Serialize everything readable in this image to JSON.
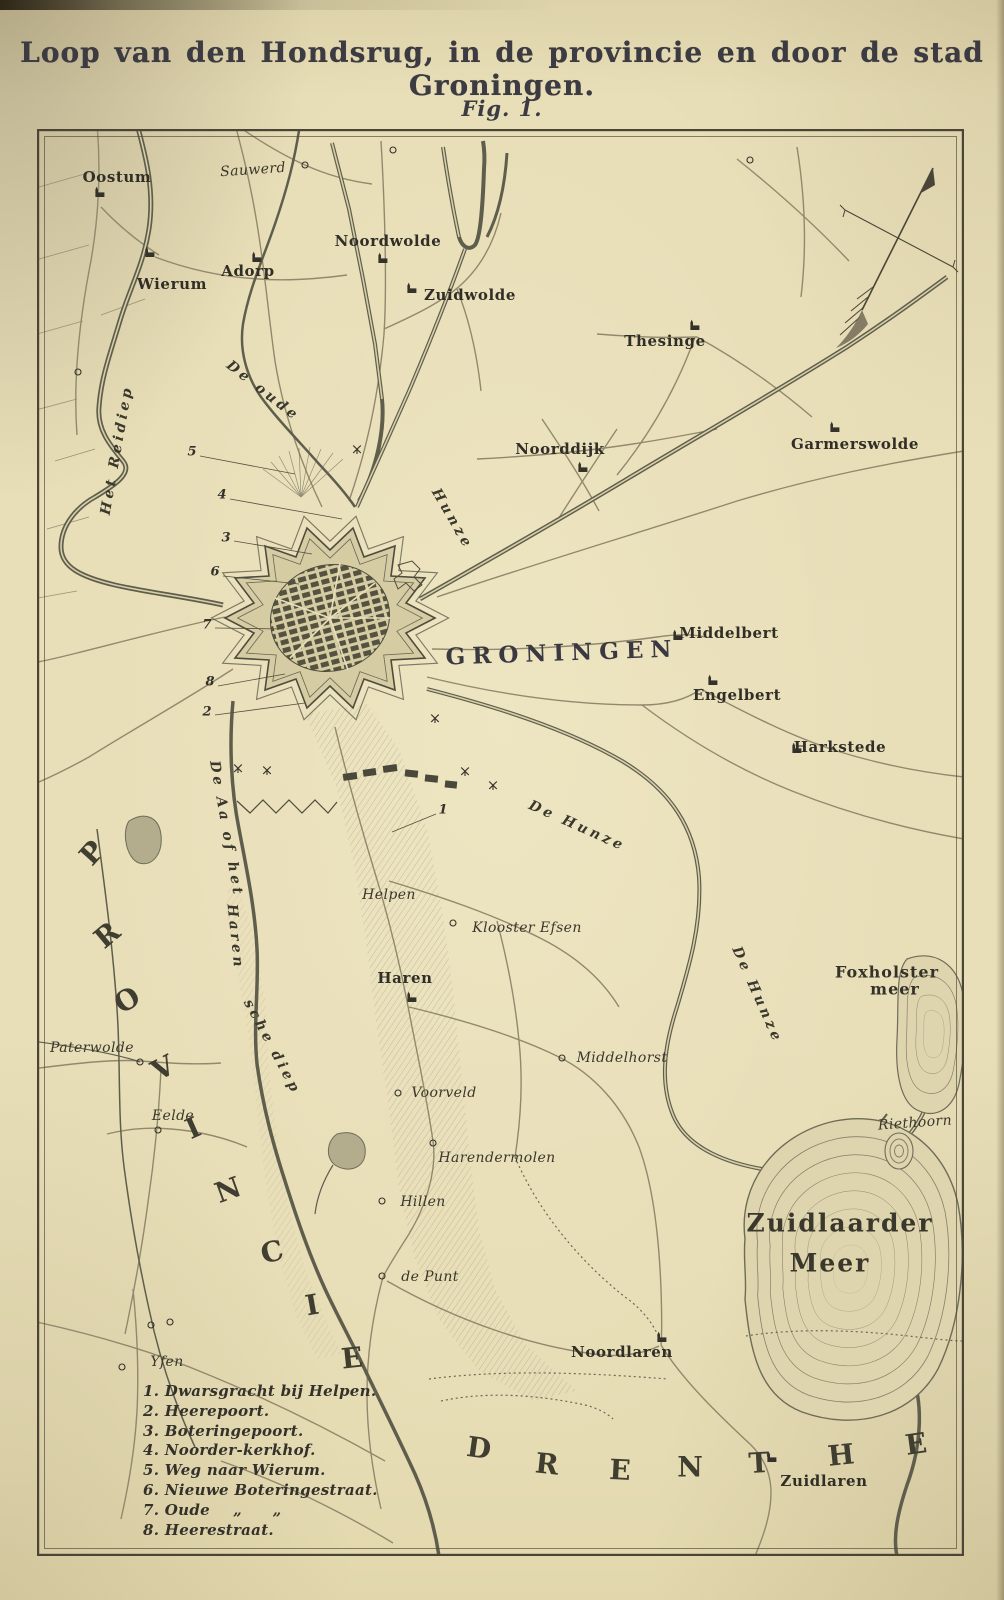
{
  "page": {
    "title": "Loop van den Hondsrug, in de provincie en door de stad Groningen.",
    "figure_caption": "Fig. 1."
  },
  "colors": {
    "paper": "#e7ddb6",
    "ink": "#3b382d",
    "water": "#5f5e4d",
    "road": "#92896d",
    "hatch": "#8f876c",
    "frame": "#4a4537"
  },
  "map": {
    "labels": [
      {
        "t": "Oostum",
        "x": 80,
        "y": 48,
        "c": "village"
      },
      {
        "t": "Sauwerd",
        "x": 216,
        "y": 41,
        "r": -4,
        "c": "hamlet"
      },
      {
        "t": "Noordwolde",
        "x": 351,
        "y": 112,
        "c": "village"
      },
      {
        "t": "Zuidwolde",
        "x": 433,
        "y": 166,
        "c": "village"
      },
      {
        "t": "Wierum",
        "x": 135,
        "y": 155,
        "c": "village"
      },
      {
        "t": "Adorp",
        "x": 211,
        "y": 142,
        "c": "village"
      },
      {
        "t": "Thesinge",
        "x": 628,
        "y": 212,
        "c": "village"
      },
      {
        "t": "Noorddijk",
        "x": 523,
        "y": 320,
        "c": "village"
      },
      {
        "t": "Garmerswolde",
        "x": 818,
        "y": 315,
        "c": "village"
      },
      {
        "t": "GRONINGEN",
        "x": 525,
        "y": 524,
        "r": -2,
        "c": "city"
      },
      {
        "t": "Middelbert",
        "x": 692,
        "y": 504,
        "c": "village"
      },
      {
        "t": "Engelbert",
        "x": 700,
        "y": 566,
        "c": "village"
      },
      {
        "t": "Harkstede",
        "x": 803,
        "y": 618,
        "c": "village"
      },
      {
        "t": "Helpen",
        "x": 352,
        "y": 766,
        "c": "hamlet"
      },
      {
        "t": "Klooster Efsen",
        "x": 490,
        "y": 799,
        "c": "hamlet"
      },
      {
        "t": "Haren",
        "x": 368,
        "y": 849,
        "c": "village"
      },
      {
        "t": "Middelhorst",
        "x": 585,
        "y": 929,
        "c": "hamlet"
      },
      {
        "t": "Voorveld",
        "x": 407,
        "y": 964,
        "c": "hamlet"
      },
      {
        "t": "Harendermolen",
        "x": 460,
        "y": 1029,
        "c": "hamlet"
      },
      {
        "t": "Hillen",
        "x": 386,
        "y": 1073,
        "c": "hamlet"
      },
      {
        "t": "de Punt",
        "x": 393,
        "y": 1148,
        "c": "hamlet"
      },
      {
        "t": "Paterwolde",
        "x": 55,
        "y": 919,
        "c": "hamlet"
      },
      {
        "t": "Eelde",
        "x": 136,
        "y": 987,
        "c": "hamlet"
      },
      {
        "t": "Yfen",
        "x": 130,
        "y": 1233,
        "c": "hamlet"
      },
      {
        "t": "Noordlaren",
        "x": 585,
        "y": 1223,
        "c": "village"
      },
      {
        "t": "Zuidlaren",
        "x": 787,
        "y": 1352,
        "c": "village"
      },
      {
        "t": "Riethoorn",
        "x": 878,
        "y": 994,
        "r": -4,
        "c": "hamlet"
      },
      {
        "t": "Foxholster",
        "x": 850,
        "y": 843,
        "c": "water-name"
      },
      {
        "t": "meer",
        "x": 858,
        "y": 860,
        "c": "water-name"
      },
      {
        "t": "Zuidlaarder",
        "x": 803,
        "y": 1094,
        "c": "lake-name"
      },
      {
        "t": "Meer",
        "x": 793,
        "y": 1134,
        "c": "lake-name"
      },
      {
        "t": "Het Reidiep",
        "x": 80,
        "y": 321,
        "r": -80,
        "c": "river"
      },
      {
        "t": "De oude",
        "x": 226,
        "y": 262,
        "r": 38,
        "c": "river"
      },
      {
        "t": "Hunze",
        "x": 415,
        "y": 390,
        "r": 60,
        "c": "river"
      },
      {
        "t": "De Hunze",
        "x": 540,
        "y": 697,
        "r": 24,
        "c": "river"
      },
      {
        "t": "De Hunze",
        "x": 720,
        "y": 866,
        "r": 66,
        "c": "river"
      },
      {
        "t": "De Aa of het",
        "x": 189,
        "y": 700,
        "r": 80,
        "c": "river"
      },
      {
        "t": "Haren",
        "x": 198,
        "y": 808,
        "r": 84,
        "c": "river"
      },
      {
        "t": "sche diep",
        "x": 235,
        "y": 918,
        "r": 62,
        "c": "river"
      }
    ],
    "regions": [
      {
        "word": "PROVINCIE",
        "letters": [
          {
            "ch": "P",
            "x": 55,
            "y": 724,
            "r": -48
          },
          {
            "ch": "R",
            "x": 70,
            "y": 806,
            "r": -40
          },
          {
            "ch": "O",
            "x": 90,
            "y": 871,
            "r": -32
          },
          {
            "ch": "V",
            "x": 126,
            "y": 939,
            "r": -28
          },
          {
            "ch": "I",
            "x": 156,
            "y": 999,
            "r": -24
          },
          {
            "ch": "N",
            "x": 191,
            "y": 1061,
            "r": -20
          },
          {
            "ch": "C",
            "x": 235,
            "y": 1123,
            "r": -14
          },
          {
            "ch": "I",
            "x": 275,
            "y": 1176,
            "r": -10
          },
          {
            "ch": "E",
            "x": 315,
            "y": 1229,
            "r": -6
          }
        ]
      },
      {
        "word": "DRENTHE",
        "letters": [
          {
            "ch": "D",
            "x": 442,
            "y": 1319,
            "r": 8
          },
          {
            "ch": "R",
            "x": 510,
            "y": 1335,
            "r": 6
          },
          {
            "ch": "E",
            "x": 583,
            "y": 1341,
            "r": 3
          },
          {
            "ch": "N",
            "x": 653,
            "y": 1338,
            "r": 0
          },
          {
            "ch": "T",
            "x": 722,
            "y": 1334,
            "r": -3
          },
          {
            "ch": "H",
            "x": 804,
            "y": 1326,
            "r": -6
          },
          {
            "ch": "E",
            "x": 879,
            "y": 1315,
            "r": -8
          }
        ]
      }
    ],
    "numbers": [
      {
        "t": "5",
        "x": 155,
        "y": 323
      },
      {
        "t": "4",
        "x": 185,
        "y": 366
      },
      {
        "t": "3",
        "x": 189,
        "y": 409
      },
      {
        "t": "6",
        "x": 178,
        "y": 443
      },
      {
        "t": "7",
        "x": 170,
        "y": 496
      },
      {
        "t": "8",
        "x": 173,
        "y": 553
      },
      {
        "t": "2",
        "x": 170,
        "y": 583
      },
      {
        "t": "1",
        "x": 406,
        "y": 681
      }
    ],
    "legend": {
      "items": [
        "1. Dwarsgracht bij Helpen.",
        "2. Heerepoort.",
        "3. Boteringepoort.",
        "4. Noorder-kerkhof.",
        "5. Weg naar Wierum.",
        "6. Nieuwe Boteringestraat.",
        "7. Oude  „  „",
        "8. Heerestraat."
      ]
    },
    "markers": {
      "churches": [
        [
          63,
          68
        ],
        [
          113,
          128
        ],
        [
          220,
          133
        ],
        [
          346,
          134
        ],
        [
          375,
          164
        ],
        [
          658,
          201
        ],
        [
          546,
          343
        ],
        [
          798,
          303
        ],
        [
          641,
          511
        ],
        [
          676,
          556
        ],
        [
          760,
          624
        ],
        [
          375,
          873
        ],
        [
          625,
          1213
        ],
        [
          735,
          1333
        ]
      ],
      "circles": [
        [
          268,
          36
        ],
        [
          356,
          21
        ],
        [
          41,
          243
        ],
        [
          713,
          31
        ],
        [
          416,
          794
        ],
        [
          525,
          929
        ],
        [
          361,
          964
        ],
        [
          396,
          1014
        ],
        [
          345,
          1072
        ],
        [
          345,
          1147
        ],
        [
          103,
          933
        ],
        [
          121,
          1001
        ],
        [
          114,
          1196
        ],
        [
          133,
          1193
        ],
        [
          85,
          1238
        ]
      ],
      "windmills": [
        [
          320,
          325
        ],
        [
          398,
          594
        ],
        [
          428,
          647
        ],
        [
          456,
          661
        ],
        [
          201,
          644
        ],
        [
          230,
          646
        ]
      ]
    },
    "compass": {
      "name": "north-arrow"
    }
  }
}
